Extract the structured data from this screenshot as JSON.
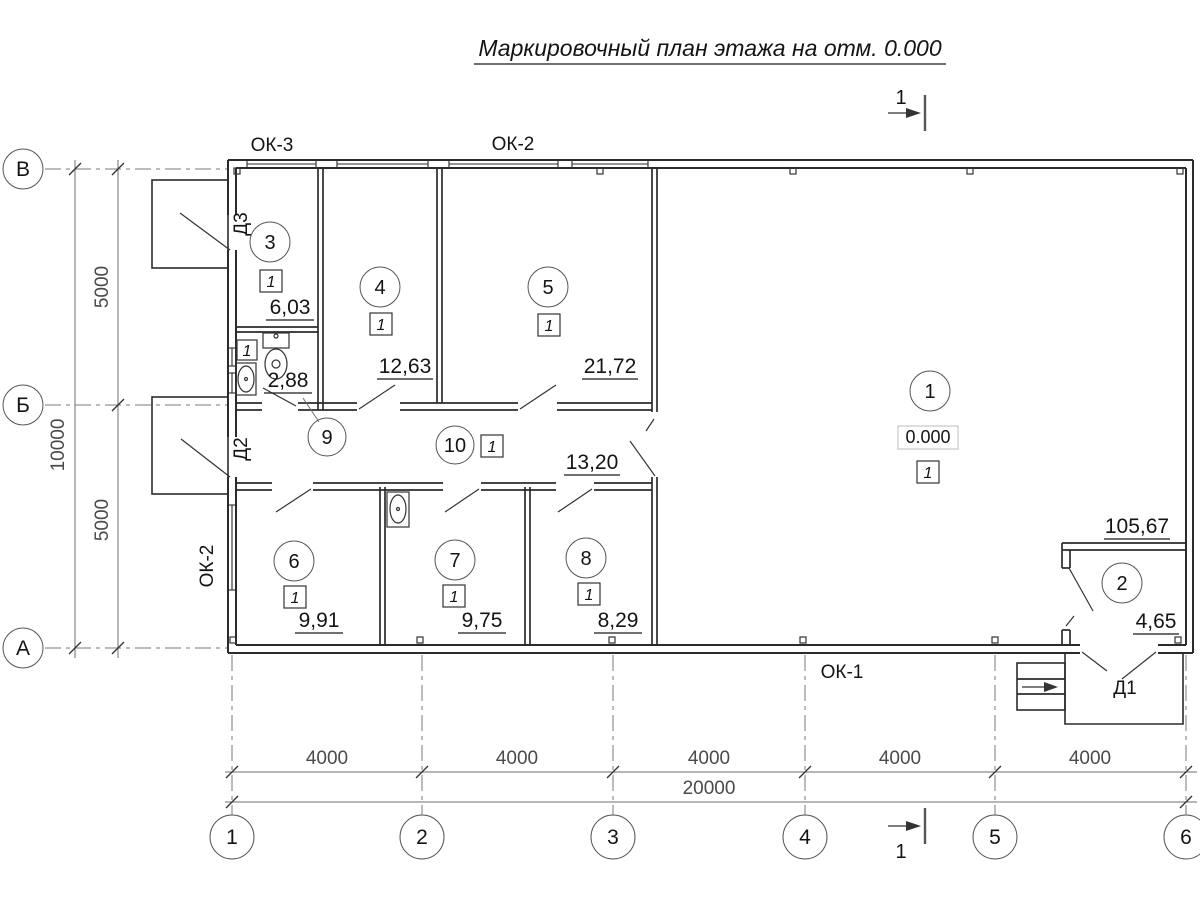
{
  "title": {
    "text": "Маркировочный план этажа на отм. 0.000"
  },
  "section": {
    "label": "1"
  },
  "axes": {
    "rows": [
      "В",
      "Б",
      "А"
    ],
    "cols": [
      "1",
      "2",
      "3",
      "4",
      "5",
      "6"
    ]
  },
  "dims": {
    "left": [
      "5000",
      "10000",
      "5000"
    ],
    "bottom": [
      "4000",
      "4000",
      "4000",
      "4000",
      "4000"
    ],
    "total": "20000"
  },
  "windows": {
    "ok3": "ОК-3",
    "ok2_top": "ОК-2",
    "ok2_left": "ОК-2",
    "ok1": "ОК-1"
  },
  "doors": {
    "d1": "Д1",
    "d2": "Д2",
    "d3": "Д3"
  },
  "rooms": [
    {
      "number": "1",
      "marker": "1",
      "area": "105,67",
      "elevation": "0.000"
    },
    {
      "number": "2",
      "area": "4,65"
    },
    {
      "number": "3",
      "marker": "1",
      "area": "6,03"
    },
    {
      "number": "4",
      "marker": "1",
      "area": "12,63"
    },
    {
      "number": "5",
      "marker": "1",
      "area": "21,72"
    },
    {
      "number": "6",
      "marker": "1",
      "area": "9,91"
    },
    {
      "number": "7",
      "marker": "1",
      "area": "9,75"
    },
    {
      "number": "8",
      "marker": "1",
      "area": "8,29"
    },
    {
      "number": "9",
      "marker": "1",
      "area": "2,88"
    },
    {
      "number": "10",
      "marker": "1",
      "area": "13,20"
    }
  ],
  "colors": {
    "line": "#2b2b2b",
    "dim": "#4a4a4a",
    "background": "#ffffff"
  }
}
